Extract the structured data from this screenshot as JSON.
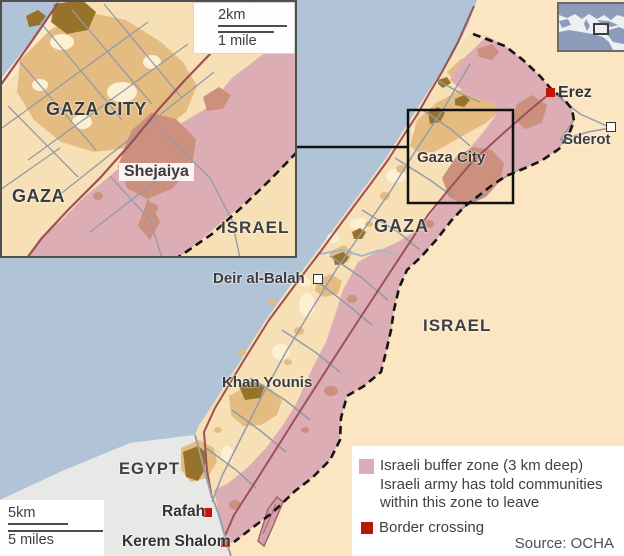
{
  "map": {
    "country_labels": {
      "gaza": "GAZA",
      "israel": "ISRAEL",
      "egypt": "EGYPT"
    },
    "town_labels": {
      "gaza_city": "Gaza City",
      "khan_younis": "Khan Younis",
      "deir_al_balah": "Deir al-Balah",
      "sderot": "Sderot"
    },
    "crossing_labels": {
      "erez": "Erez",
      "rafah": "Rafah",
      "kerem_shalom": "Kerem Shalom"
    },
    "markers": {
      "border_crossings": [
        "Erez",
        "Rafah",
        "Kerem Shalom"
      ],
      "towns": [
        "Sderot",
        "Deir al-Balah"
      ]
    }
  },
  "inset": {
    "labels": {
      "gaza_city": "GAZA CITY",
      "gaza": "GAZA",
      "shejaiya": "Shejaiya",
      "israel": "ISRAEL"
    },
    "scale": {
      "metric": "2km",
      "imperial": "1 mile"
    }
  },
  "main_scale": {
    "metric": "5km",
    "imperial": "5 miles"
  },
  "legend": {
    "buffer_lines": [
      "Israeli buffer zone (3 km deep)",
      "Israeli army has told communities",
      "within this zone to leave"
    ],
    "border_crossing": "Border crossing",
    "source": "Source: OCHA"
  },
  "colors": {
    "sea": "#b1c3d7",
    "israel_land": "#fbe6c1",
    "gaza_land": "#f8e0b6",
    "egypt_land": "#e8e8e6",
    "urban": "#e4bc82",
    "dense_urban": "#96722a",
    "buffer_zone": "#dcadb4",
    "buffer_urban": "#cb907e",
    "border_crossing_red": "#c3150b",
    "main_road": "#9c5158",
    "minor_road": "#939aa8",
    "border_dash": "#141414",
    "locator_land": "#8b9dbb"
  }
}
